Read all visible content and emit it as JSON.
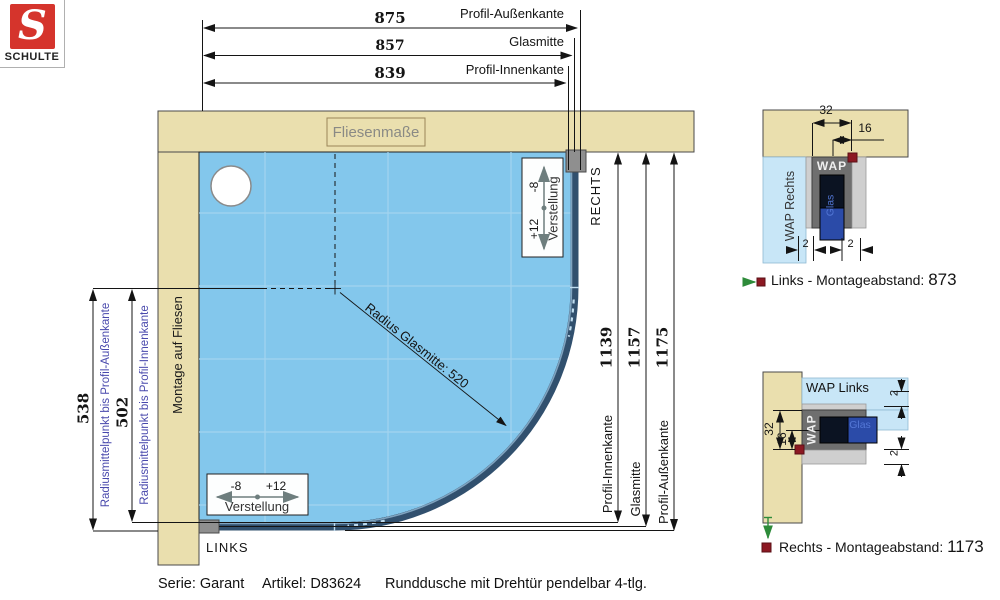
{
  "brand": {
    "letter": "S",
    "name": "SCHULTE"
  },
  "top_dims": [
    {
      "value": "875",
      "label": "Profil-Außenkante"
    },
    {
      "value": "857",
      "label": "Glasmitte"
    },
    {
      "value": "839",
      "label": "Profil-Innenkante"
    }
  ],
  "left_dims": [
    {
      "value": "538",
      "label": "Radiusmittelpunkt bis Profil-Außenkante"
    },
    {
      "value": "502",
      "label": "Radiusmittelpunkt bis Profil-Innenkante"
    }
  ],
  "right_dims": [
    {
      "value": "1139",
      "label": "Profil-Innenkante"
    },
    {
      "value": "1157",
      "label": "Glasmitte"
    },
    {
      "value": "1175",
      "label": "Profil-Außenkante"
    }
  ],
  "plan": {
    "tile_box": "Fliesenmaße",
    "wall_label": "Montage auf Fliesen",
    "radius_label": "Radius Glasmitte: 520",
    "right": "RECHTS",
    "left": "LINKS",
    "adjust": {
      "minus": "-8",
      "plus": "+12",
      "label": "Verstellung"
    }
  },
  "detail_top": {
    "area": "WAP Rechts",
    "wap": "WAP",
    "glas": "Glas",
    "d32": "32",
    "d16": "16",
    "d2l": "2",
    "d2r": "2",
    "caption": "Links - Montageabstand:",
    "value": "873"
  },
  "detail_bottom": {
    "area": "WAP Links",
    "wap": "WAP",
    "glas": "Glas",
    "d32": "32",
    "d16": "16",
    "d2t": "2",
    "d2b": "2",
    "caption": "Rechts - Montageabstand:",
    "value": "1173"
  },
  "footer": {
    "series": "Serie: Garant",
    "article": "Artikel: D83624",
    "description": "Runddusche mit Drehtür pendelbar 4-tlg."
  },
  "colors": {
    "wall": "#EADFAE",
    "tray": "#83C7EC",
    "profile": "#31506E",
    "brand_red": "#D5342C",
    "marker_red": "#8C1822",
    "green": "#2E8B3A",
    "label_blue": "#4848AC"
  }
}
